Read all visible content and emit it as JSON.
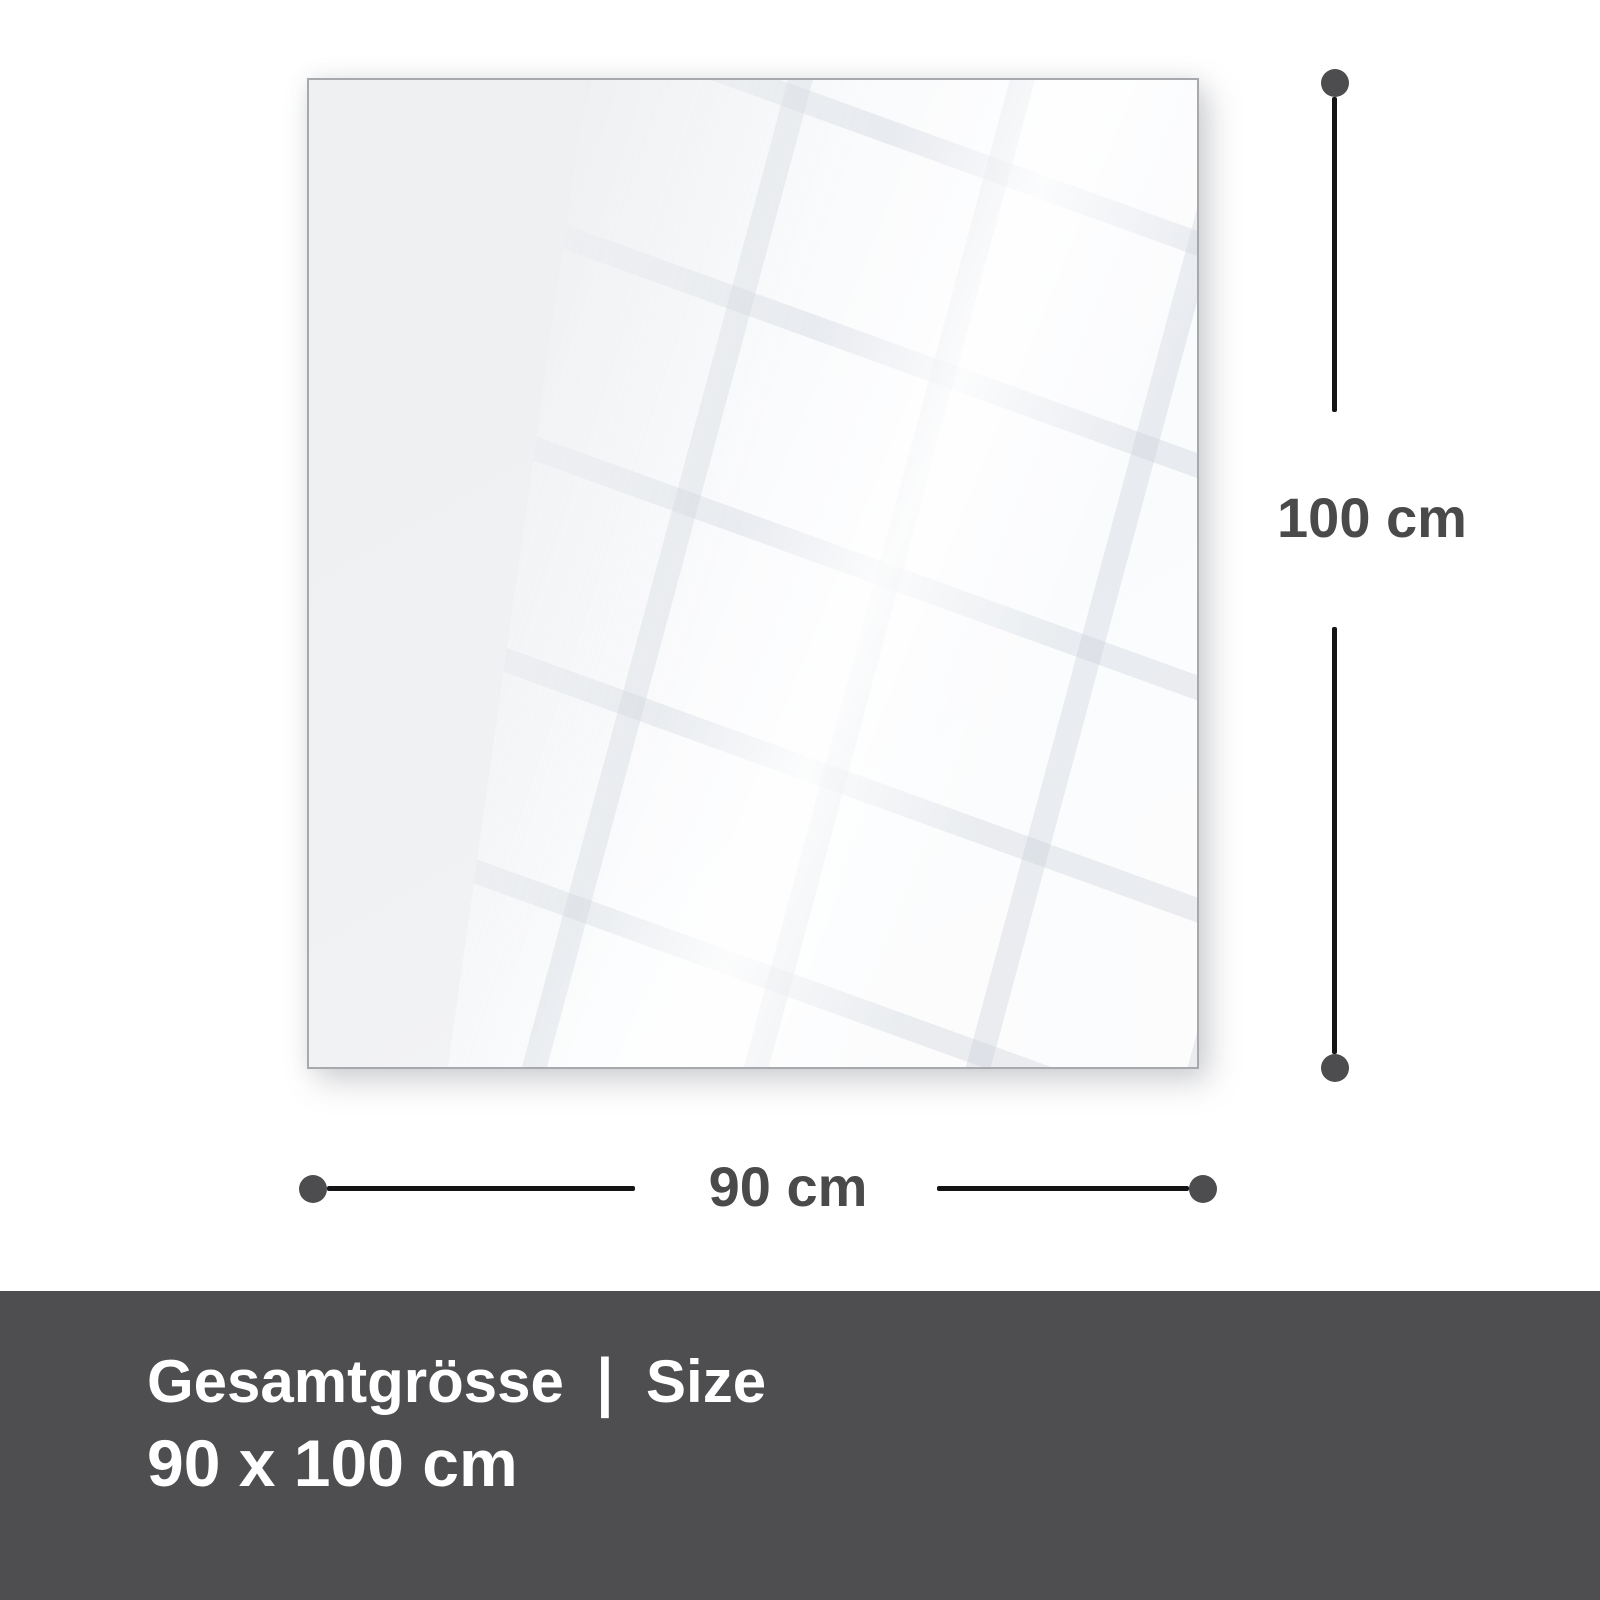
{
  "diagram": {
    "panel_name": "glass panel preview",
    "vertical_dimension": {
      "label": "100 cm"
    },
    "horizontal_dimension": {
      "label": "90 cm"
    }
  },
  "footer": {
    "label_de": "Gesamtgrösse",
    "separator": "|",
    "label_en": "Size",
    "size_value": "90 x 100 cm"
  },
  "colors": {
    "background": "#ffffff",
    "panel_fill": "#f0f1f3",
    "panel_border": "#a7a9ac",
    "reflection_tile": "#fdfeff",
    "dimension_line": "#141414",
    "dimension_endpoint": "#4d4d4f",
    "dimension_label_text": "#4a4a4b",
    "footer_background": "#4e4e50",
    "footer_text": "#ffffff"
  }
}
